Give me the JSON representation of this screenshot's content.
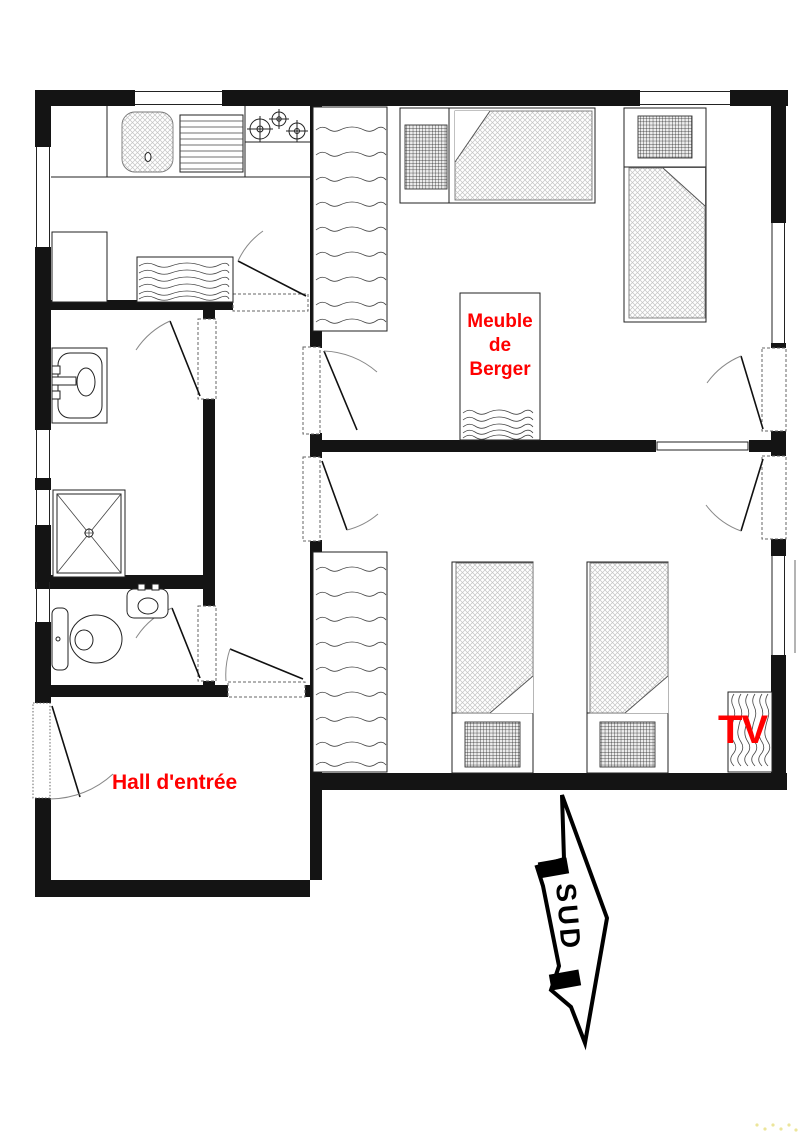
{
  "labels": {
    "meuble_lines": [
      "Meuble",
      "de",
      "Berger"
    ],
    "hall": "Hall d'entrée",
    "tv": "TV",
    "sud": "SUD"
  },
  "colors": {
    "label_red": "#ff0000",
    "wall_black": "#141414",
    "arrow_black": "#000000",
    "background": "#ffffff"
  },
  "fixtures": [
    "kitchen-sink",
    "drainboard",
    "stove-burners",
    "refrigerator",
    "doormat",
    "washbasin",
    "shower",
    "toilet",
    "wc-basin",
    "wardrobe",
    "wardrobe",
    "single-bed",
    "single-bed",
    "single-bed",
    "single-bed",
    "meuble-de-berger-cabinet",
    "tv-cabinet",
    "south-arrow"
  ]
}
